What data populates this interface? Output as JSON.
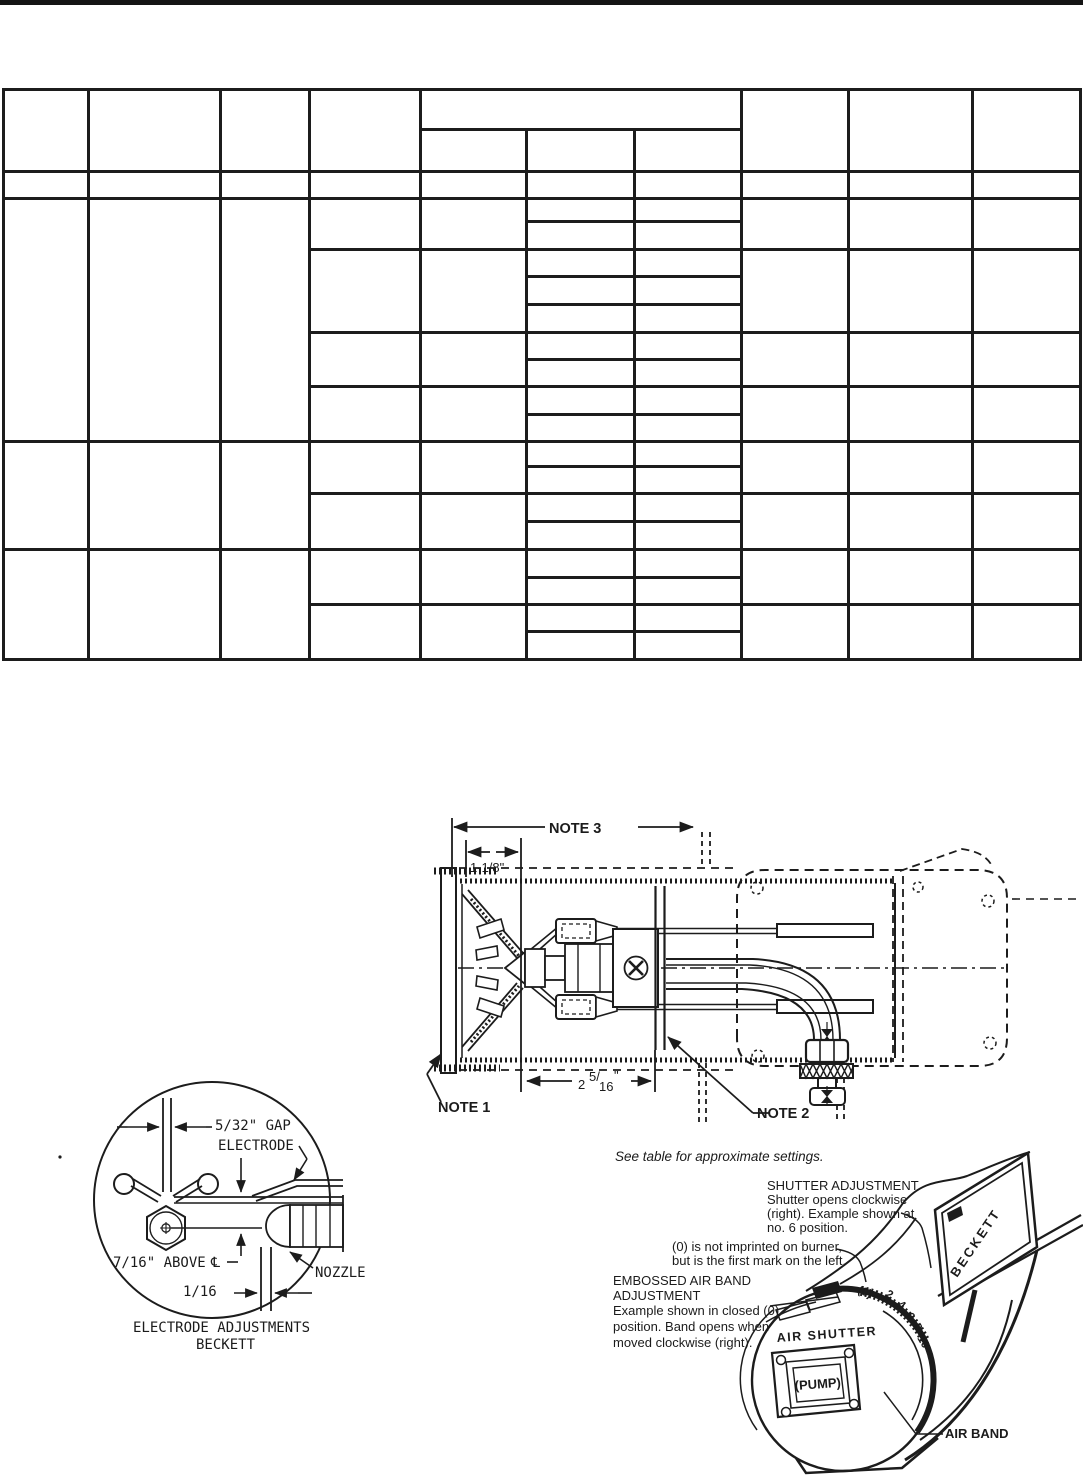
{
  "top_view": {
    "note3": "NOTE 3",
    "dim_top": "1-1/8\"",
    "note1": "NOTE 1",
    "note2": "NOTE 2",
    "dim_front": {
      "whole": "2",
      "sup": "5/",
      "sub": "16",
      "unit": "\""
    },
    "see_table": "See table for approximate settings."
  },
  "electrode_detail": {
    "gap": "5/32\" GAP",
    "electrode": "ELECTRODE",
    "above": "7/16\" ABOVE",
    "centerline_symbol": "℄",
    "sixteenth": "1/16",
    "nozzle": "NOZZLE",
    "caption_line1": "ELECTRODE ADJUSTMENTS",
    "caption_line2": "BECKETT"
  },
  "burner_view": {
    "shutter_heading": "SHUTTER ADJUSTMENT",
    "shutter_line1": "Shutter opens clockwise",
    "shutter_line2": "(right). Example shown at",
    "shutter_line3": "no. 6 position.",
    "zero_line1": "(0) is not imprinted on burner,",
    "zero_line2": "but is the first mark on the left.",
    "airband_heading1": "EMBOSSED AIR BAND",
    "airband_heading2": "ADJUSTMENT",
    "airband_line1": "Example shown in closed (0)",
    "airband_line2": "position. Band opens when",
    "airband_line3": "moved clockwise (right).",
    "air_shutter": "AIR SHUTTER",
    "pump": "(PUMP)",
    "air_band": "AIR BAND",
    "brand": "BECKETT",
    "dial": [
      "(0)",
      "2",
      "4",
      "6",
      "8",
      "10"
    ]
  }
}
